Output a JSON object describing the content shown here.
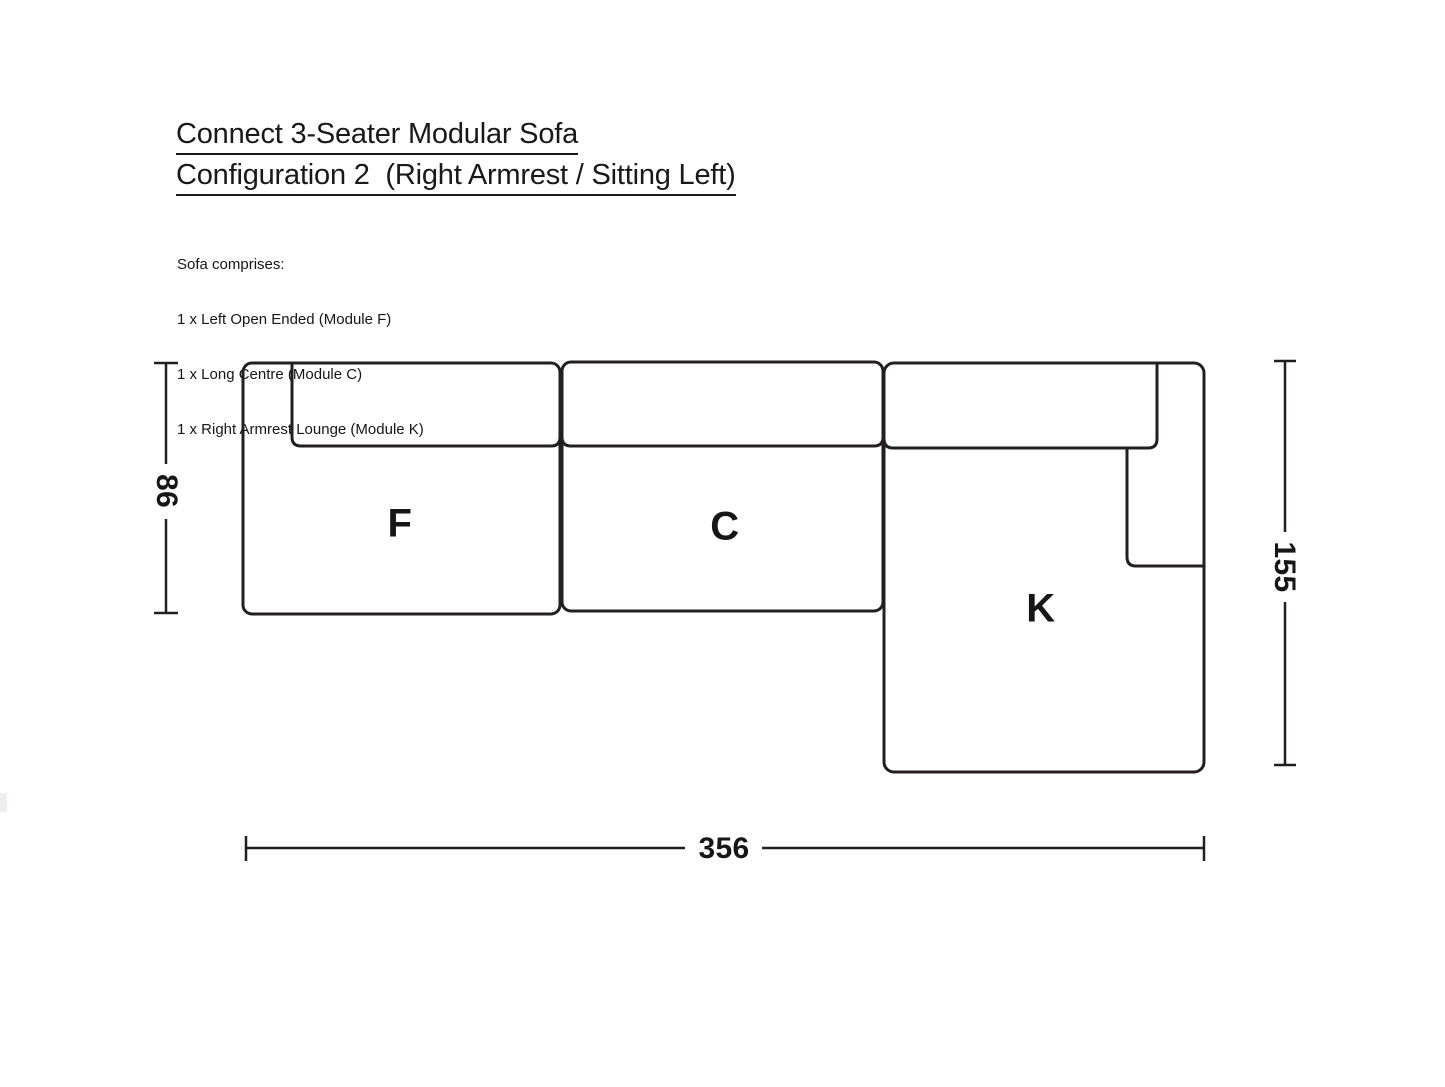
{
  "header": {
    "title_line1": "Connect 3-Seater Modular Sofa",
    "title_line2": "Configuration 2  (Right Armrest / Sitting Left)"
  },
  "description": {
    "intro": "Sofa comprises:",
    "items": [
      "1 x Left Open Ended (Module F)",
      "1 x Long Centre (Module C)",
      "1 x Right Armrest Lounge (Module K)"
    ]
  },
  "diagram": {
    "module_labels": {
      "f": "F",
      "c": "C",
      "k": "K"
    },
    "dimensions": {
      "left": "86",
      "right": "155",
      "bottom": "356"
    },
    "line_color": "#231f20",
    "background": "#ffffff"
  }
}
